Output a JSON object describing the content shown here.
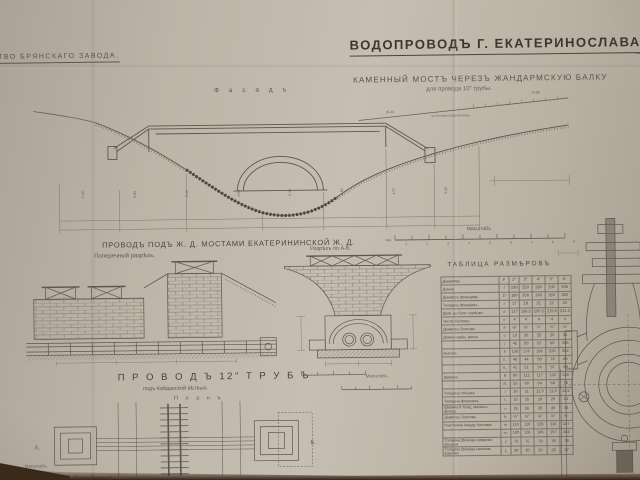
{
  "photo_note": "photograph of an old Russian engineering drawing",
  "colors": {
    "paper": "#bdb4a8",
    "ink": "#45403a",
    "line": "#6a6258",
    "shadow": "#352416"
  },
  "header": {
    "left_title": "СТВО  БРЯНСКАГО  ЗАВОДА.",
    "main_title": "ВОДОПРОВОДЪ  Г. ЕКАТЕРИНОСЛАВА.",
    "subtitle": "КАМЕННЫЙ  МОСТЪ  ЧЕРЕЗЪ  ЖАНДАРМСКУЮ  БАЛКУ",
    "subtitle2": "для  провода  10\"  трубы."
  },
  "facade": {
    "label": "Ф а с а д ъ",
    "elev_right": "14.85",
    "elev_mid": "16.40",
    "street_note": "уг. Елисаветградской улицы",
    "dims": [
      "4.48",
      "0.85",
      "6.40",
      "0.61",
      "5.12",
      "2.84",
      "1.07",
      "3.20"
    ]
  },
  "scalebar_main": {
    "label": "Масштабъ",
    "unit": "саж.",
    "nums": [
      "1",
      "2",
      "3",
      "4",
      "5",
      "6",
      "7",
      "8",
      "9"
    ]
  },
  "section1": {
    "heading": "ПРОВОДЪ  ПОДЪ  Ж. Д.  МОСТАМИ  ЕКАТЕРИНИНСКОЙ  Ж. Д.",
    "left_label": "Поперечный разрѣзъ.",
    "right_label": "Разрѣзъ  по  А-Б.",
    "ab_scale_label": "Масштабъ"
  },
  "plan12": {
    "heading": "П Р О В О Д Ъ   12\"  Т Р У Б Ъ",
    "sub": "подъ  Кайдакской  вѣтвью.",
    "plan_label": "П л а н ъ",
    "marker_left": "А.",
    "marker_right": "Б.",
    "scale_label": "Масштабъ."
  },
  "table": {
    "title": "ТАБЛИЦА  РАЗМѢРОВЪ",
    "header": [
      "Діаметръ",
      "Р",
      "2″",
      "3″",
      "4″",
      "5″",
      "6″"
    ],
    "rows": [
      {
        "label": "Длина",
        "sym": "l",
        "values": [
          "230",
          "250",
          "280",
          "290",
          "306"
        ]
      },
      {
        "label": "Діаметръ фланцевъ",
        "sym": "D",
        "values": [
          "180",
          "200",
          "240",
          "260",
          "280"
        ]
      },
      {
        "label": "Толщина фланцевъ",
        "sym": "t",
        "values": [
          "17",
          "18",
          "21",
          "21",
          "23"
        ]
      },
      {
        "label": "Діам. до болт. нарѣзки",
        "sym": "d",
        "values": [
          "127",
          "166.5",
          "190.2",
          "215.9",
          "241.3"
        ]
      },
      {
        "label": "Число болтовъ",
        "sym": "n",
        "values": [
          "4",
          "4",
          "4",
          "4",
          "4"
        ]
      },
      {
        "label": "Діаметръ болтовъ",
        "sym": "b",
        "values": [
          "⅝″",
          "⅝″",
          "¾″",
          "¾″",
          "¾″"
        ]
      },
      {
        "label": "Длина нарѣз. винта",
        "sym": "a",
        "values": [
          "19",
          "20",
          "25",
          "29",
          "31"
        ]
      },
      {
        "label": "",
        "sym": "c",
        "values": [
          "45",
          "50",
          "55",
          "60",
          "105"
        ]
      },
      {
        "label": "Высота.",
        "sym": "h",
        "values": [
          "139",
          "174",
          "196",
          "225",
          "252"
        ]
      },
      {
        "label": "",
        "sym": "h₁",
        "values": [
          "40",
          "44",
          "58",
          "76",
          "85"
        ]
      },
      {
        "label": "",
        "sym": "h₂",
        "values": [
          "41",
          "51",
          "54",
          "57",
          "58"
        ]
      },
      {
        "label": "Ширина",
        "sym": "B",
        "values": [
          "80",
          "112",
          "117",
          "125",
          "130"
        ]
      },
      {
        "label": "",
        "sym": "B₁",
        "values": [
          "55",
          "60",
          "64",
          "66",
          "76"
        ]
      },
      {
        "label": "Толщина стѣнокъ",
        "sym": "s",
        "values": [
          "10",
          "11",
          "11.3",
          "11.3",
          "12.5"
        ]
      },
      {
        "label": "Толщина фланцевъ",
        "sym": "s₁",
        "values": [
          "15",
          "16",
          "18",
          "20",
          "21"
        ]
      },
      {
        "label": "Ширина и толщ. малыхъ фланц.",
        "sym": "e",
        "values": [
          "25",
          "26",
          "28",
          "30",
          "34"
        ]
      },
      {
        "label": "Діаметръ болтовъ",
        "sym": "b₁",
        "values": [
          "½″",
          "½″",
          "⅝″",
          "⅝″",
          "⅝″"
        ]
      },
      {
        "label": "Разстояніе между болтами",
        "sym": "m",
        "values": [
          "110",
          "110",
          "126",
          "116",
          "127"
        ]
      },
      {
        "label": "",
        "sym": "m₁",
        "values": [
          "130",
          "136",
          "146",
          "157",
          "162"
        ]
      },
      {
        "label": "Толщина фланца соединит. крышки",
        "sym": "f",
        "values": [
          "75",
          "75",
          "76",
          "78",
          "78"
        ]
      },
      {
        "label": "Толщина фланца сальник. коробки",
        "sym": "f₁",
        "values": [
          "20",
          "20",
          "20",
          "26",
          "27"
        ]
      }
    ]
  }
}
